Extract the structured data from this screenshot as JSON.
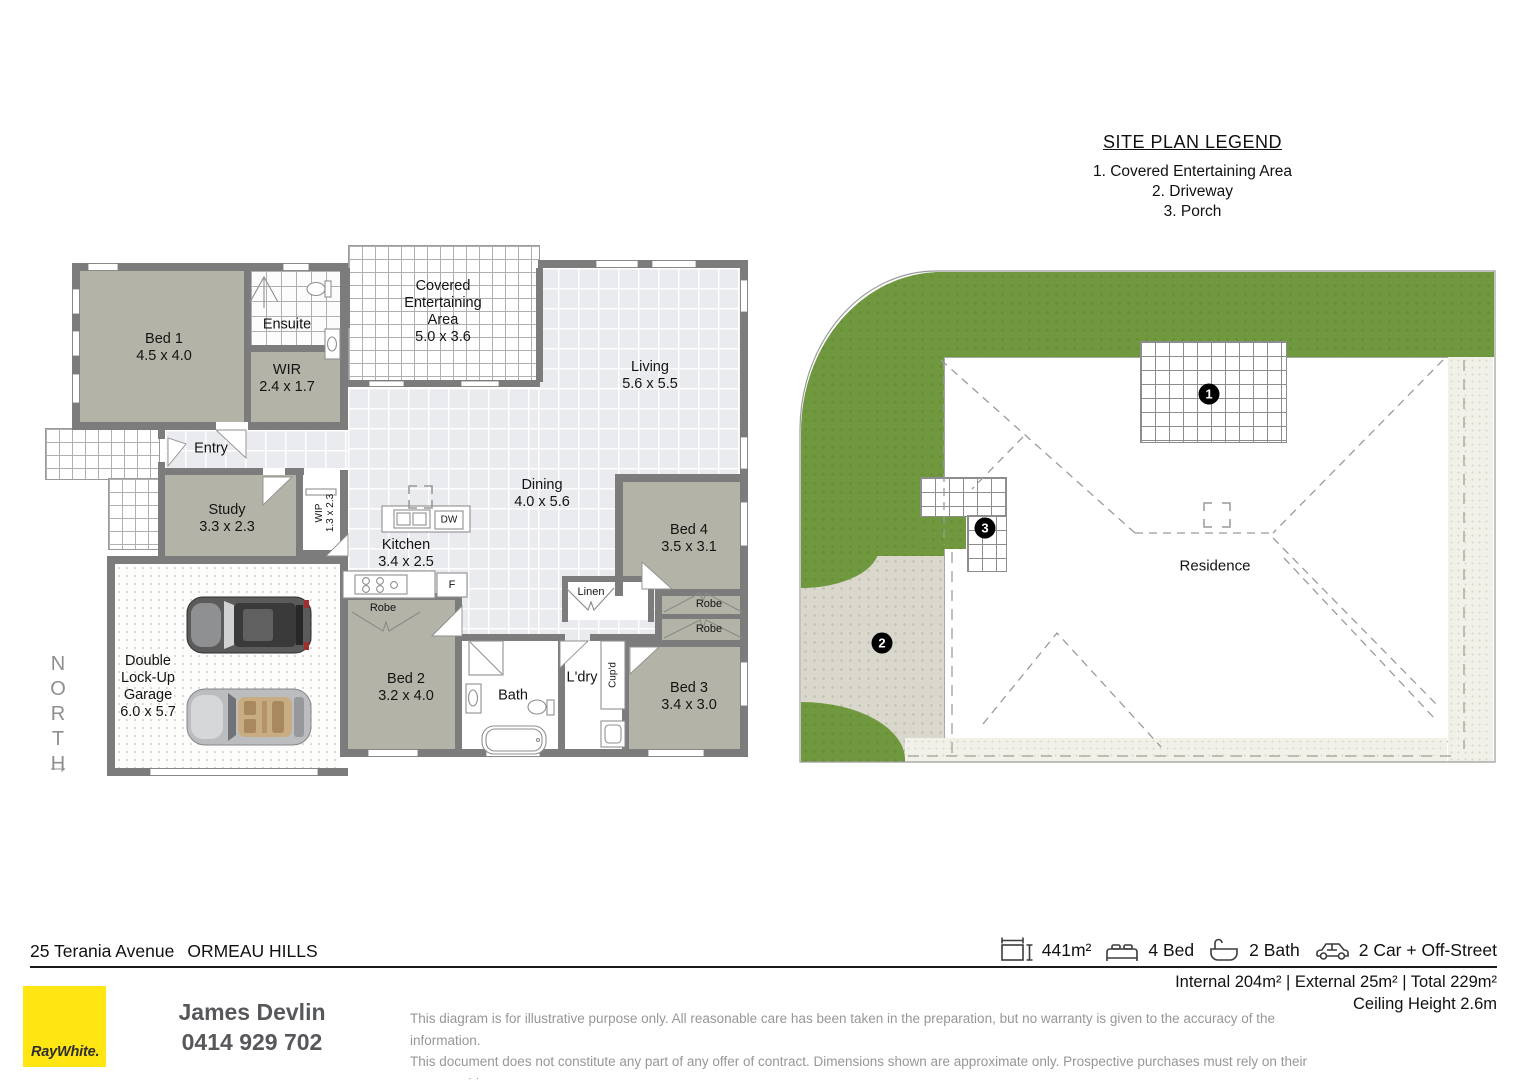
{
  "legend": {
    "title": "SITE PLAN LEGEND",
    "items": "1. Covered Entertaining Area\n2. Driveway\n3. Porch"
  },
  "floorplan": {
    "bed1": "Bed 1\n4.5 x 4.0",
    "ensuite": "Ensuite",
    "wir": "WIR\n2.4 x 1.7",
    "entry": "Entry",
    "study": "Study\n3.3 x 2.3",
    "wip": "WIP\n1.3 x 2.3",
    "kitchen": "Kitchen\n3.4 x 2.5",
    "dining": "Dining\n4.0 x 5.6",
    "living": "Living\n5.6 x 5.5",
    "covered_area": "Covered\nEntertaining\nArea\n5.0 x 3.6",
    "bed4": "Bed 4\n3.5 x 3.1",
    "bed3": "Bed 3\n3.4 x 3.0",
    "bed2": "Bed 2\n3.2 x 4.0",
    "bath": "Bath",
    "ldry": "L'dry",
    "cupd": "Cup'd",
    "linen": "Linen",
    "robe": "Robe",
    "garage": "Double\nLock-Up\nGarage\n6.0 x 5.7",
    "fridge": "F",
    "dishwasher": "DW",
    "north": "NORTH",
    "north_arrow": "→"
  },
  "siteplan": {
    "residence": "Residence",
    "marker1": "1",
    "marker2": "2",
    "marker3": "3"
  },
  "footer": {
    "address": "25 Terania Avenue",
    "suburb": "ORMEAU HILLS",
    "stat_area": "441m²",
    "stat_bed": "4 Bed",
    "stat_bath": "2 Bath",
    "stat_car": "2 Car + Off-Street",
    "areas": "Internal 204m² | External 25m² | Total 229m²",
    "ceiling": "Ceiling Height 2.6m",
    "agent_name": "James Devlin",
    "agent_phone": "0414 929 702",
    "brand": "RayWhite.",
    "disclaimer1": "This diagram is for illustrative purpose only. All reasonable care has been taken in the preparation, but no warranty is given to the accuracy of the information.",
    "disclaimer2": "This document does not constitute any part of any offer of contract. Dimensions shown are approximate only. Prospective purchases must rely on their own enquiries."
  },
  "colors": {
    "brand_yellow": "#ffe512",
    "wall_gray": "#7c7c7c",
    "grass_green": "#70993f",
    "room_beige": "#b4b3a7"
  }
}
